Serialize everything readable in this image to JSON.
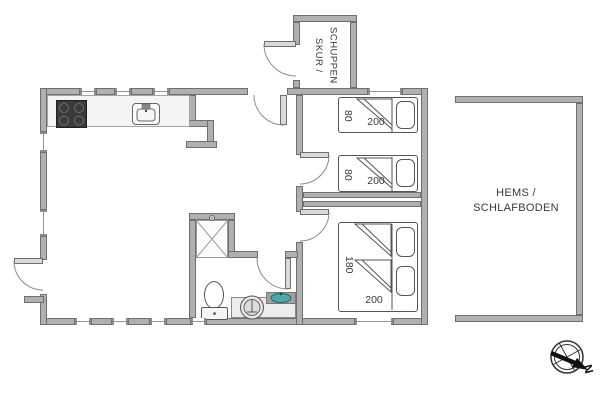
{
  "labels": {
    "shed": "SKUR /\nSCHUPPEN",
    "loft": "HEMS /\nSCHLAFBODEN",
    "north": "N"
  },
  "dimensions": {
    "single_bed_width": "80",
    "bed_length": "200",
    "double_bed_width": "180"
  },
  "colors": {
    "wall_fill": "#b0b0b0",
    "wall_edge": "#6f6f6f",
    "stove_black": "#3b3b3b",
    "sink_basin_teal": "#4fa8a8",
    "furniture_line": "#555555",
    "label_text": "#3a3a3a"
  }
}
